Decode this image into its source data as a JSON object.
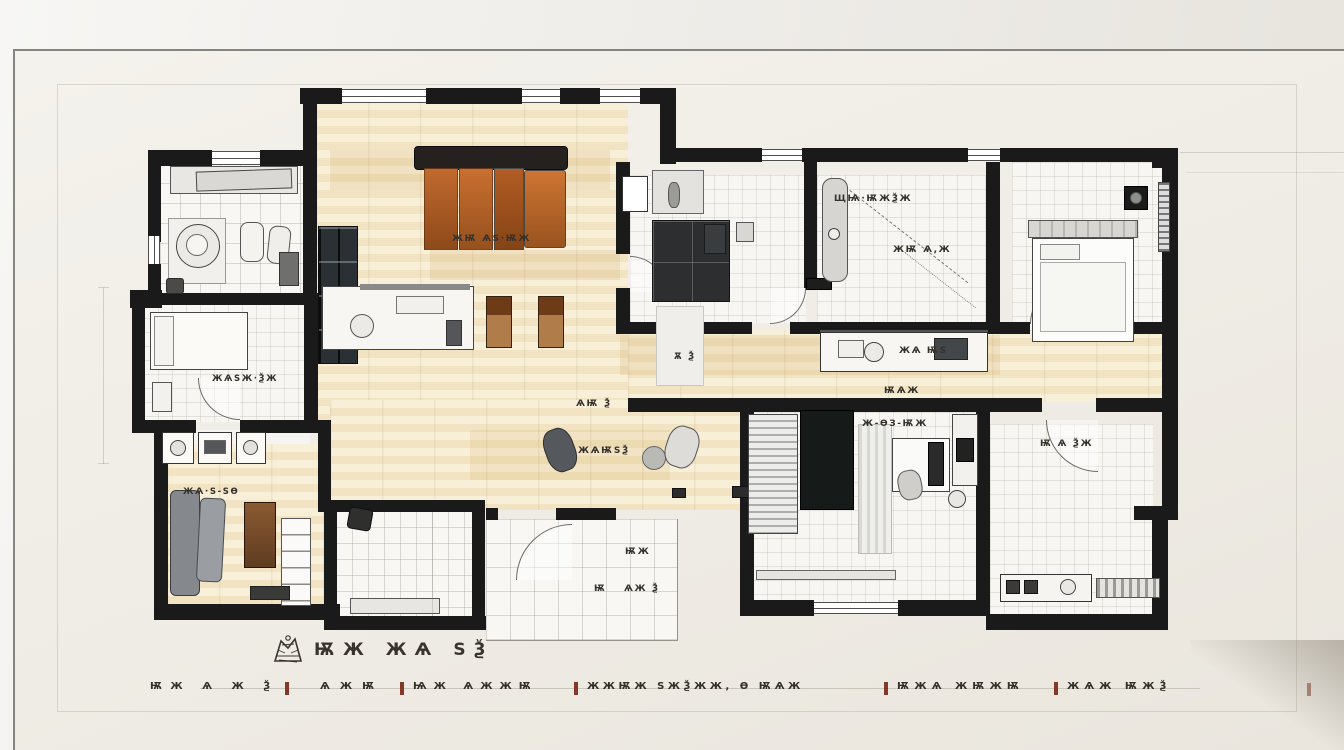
{
  "scene": {
    "kind": "hand-drawn apartment floor plan sketch pinned on a pale wall"
  },
  "title": {
    "text": "ѬЖ ЖѦ ЅѮ"
  },
  "annotations": [
    {
      "id": "living-room-label",
      "text": "ЖѬ ѦЅ·ѬЖ"
    },
    {
      "id": "bedroom-top-mid-label",
      "text": "ЩѨ·ѬЖѮЖ"
    },
    {
      "id": "study-mid-label",
      "text": "ЖѬ Ѧ,Ж"
    },
    {
      "id": "hallway-label",
      "text": "Ѫ Ѯ"
    },
    {
      "id": "kitchen-label",
      "text": "ЖѦ ѬЅ"
    },
    {
      "id": "corridor-label",
      "text": "ѬѦЖ"
    },
    {
      "id": "dining-label-1",
      "text": "ѦѬ Ѯ"
    },
    {
      "id": "dining-label-2",
      "text": "ЖѦѬЅѮ"
    },
    {
      "id": "bedroom-bottom-label",
      "text": "Ж-ѲЗ-ѬЖ"
    },
    {
      "id": "bathroom-right-label",
      "text": "Ѭ Ѧ ѮЖ"
    },
    {
      "id": "patio-label-1",
      "text": "ѬЖ"
    },
    {
      "id": "patio-label-2",
      "text": "Ѭ"
    },
    {
      "id": "patio-label-3",
      "text": "ѦЖ Ѯ"
    },
    {
      "id": "bedroom-left-label",
      "text": "ЖѦЅЖ·ѮЖ"
    },
    {
      "id": "lounge-bottom-left-label",
      "text": "ЖѦ·Ѕ-ЅѲ"
    }
  ],
  "legend": {
    "items": [
      {
        "text": "ѬЖ Ѧ Ж Ѯ"
      },
      {
        "text": "ѦЖѬ"
      },
      {
        "text": "ѨЖ ѦЖЖѬ"
      },
      {
        "text": "ЖЖѬЖ ЅЖѮЖЖ, Ѳ ѬѦЖ"
      },
      {
        "text": "ѬЖѦ ЖѬЖѬ"
      },
      {
        "text": "ЖѦЖ ѬЖѮ"
      }
    ]
  },
  "colors": {
    "wall_backdrop": "#e9e6e0",
    "paper": "#f0eee8",
    "plan_wall_ink": "#1a1a1a",
    "wood_floor": "#f3e6c6",
    "sofa_orange": "#bb6227",
    "sofa_gray": "#8b8e92",
    "cabinet_brown": "#8a5a32",
    "tile_floor": "#f8f7f4",
    "ink_text": "#35312b",
    "legend_tick": "#83392a",
    "frame_line": "#86847f",
    "corner_shadow": "#9d968b"
  }
}
